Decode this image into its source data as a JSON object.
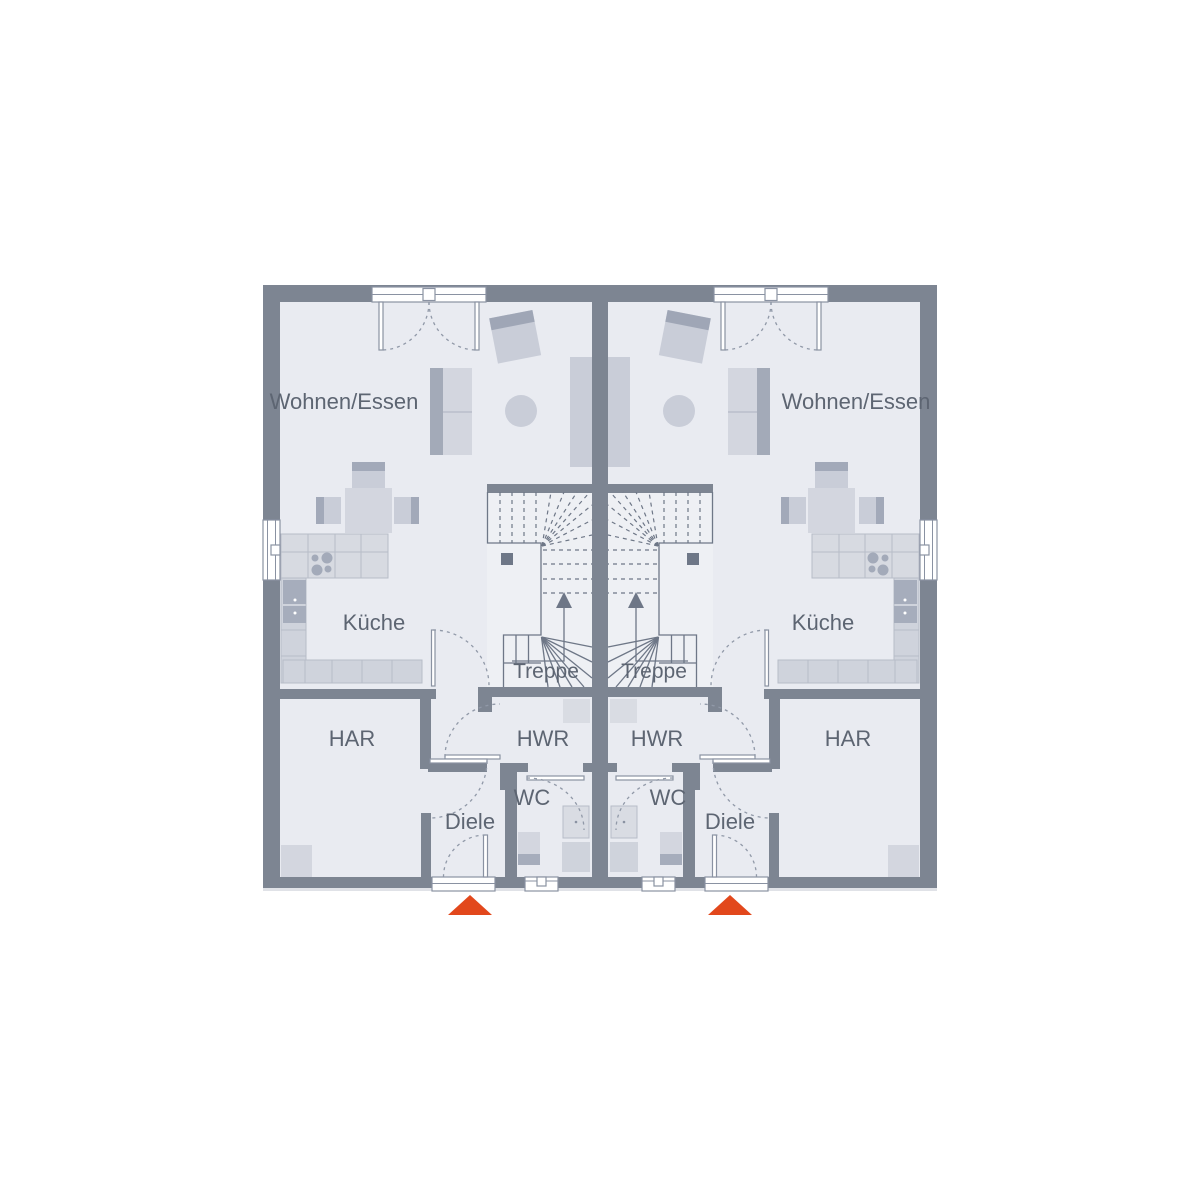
{
  "rooms": {
    "living": "Wohnen/Essen",
    "kitchen": "Küche",
    "stairs": "Treppe",
    "storage": "HAR",
    "utility": "HWR",
    "wc": "WC",
    "hall": "Diele"
  },
  "colors": {
    "wall": "#7d8592",
    "floor": "#e9ebf1",
    "stair_floor": "#eef0f4",
    "furniture_light": "#d3d6df",
    "furniture_mid": "#c9cdd8",
    "furniture_dark": "#9aa2b2",
    "plan_line": "#6e7787",
    "label_text": "#5d6572",
    "entrance_arrow": "#e2481c",
    "opening_white": "#ffffff"
  }
}
